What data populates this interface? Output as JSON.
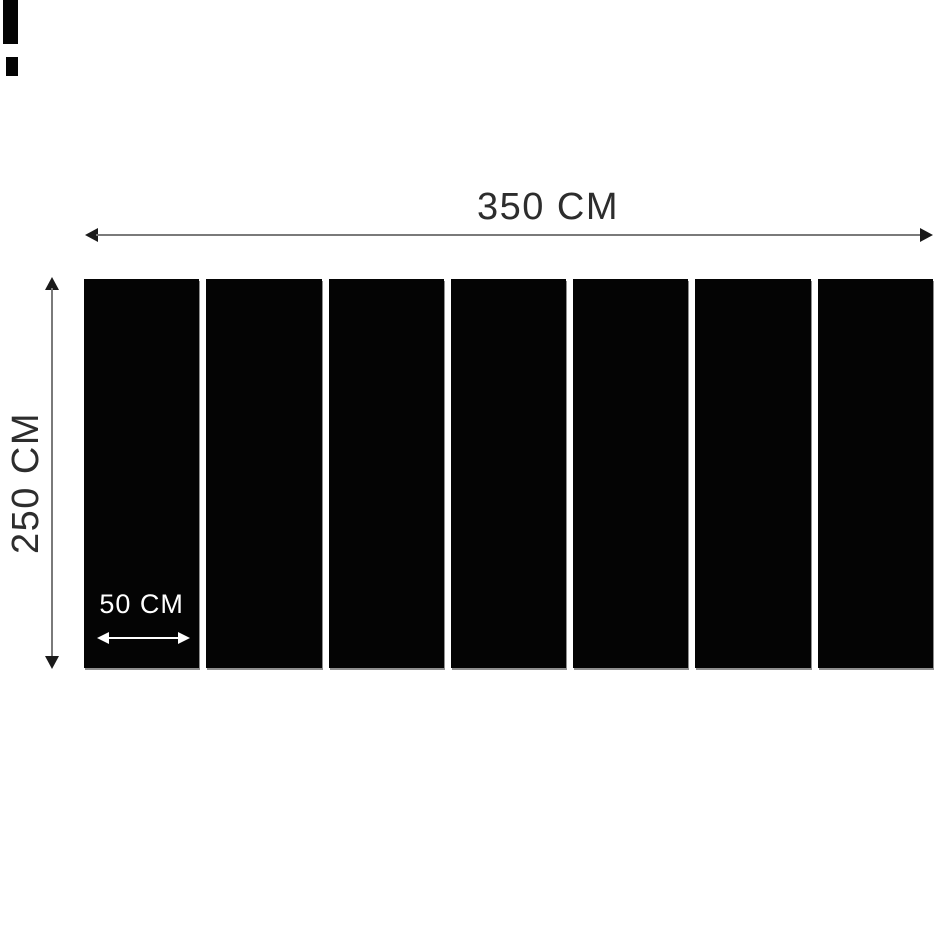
{
  "diagram": {
    "type": "product-dimension-diagram",
    "panels": {
      "count": 7
    },
    "labels": {
      "total_width": "350 CM",
      "total_height": "250 CM",
      "panel_width": "50 CM"
    },
    "artifacts": {
      "top_left_corner_marks": 2
    }
  },
  "colors": {
    "background": "#ffffff",
    "panel": "#040404",
    "dimension_line": "#7a7a7a",
    "arrowhead": "#1a1a1a",
    "label_text": "#2d2d2d",
    "panel_label_text": "#ffffff",
    "panel_edge_shadow": "#8f8f8f"
  }
}
